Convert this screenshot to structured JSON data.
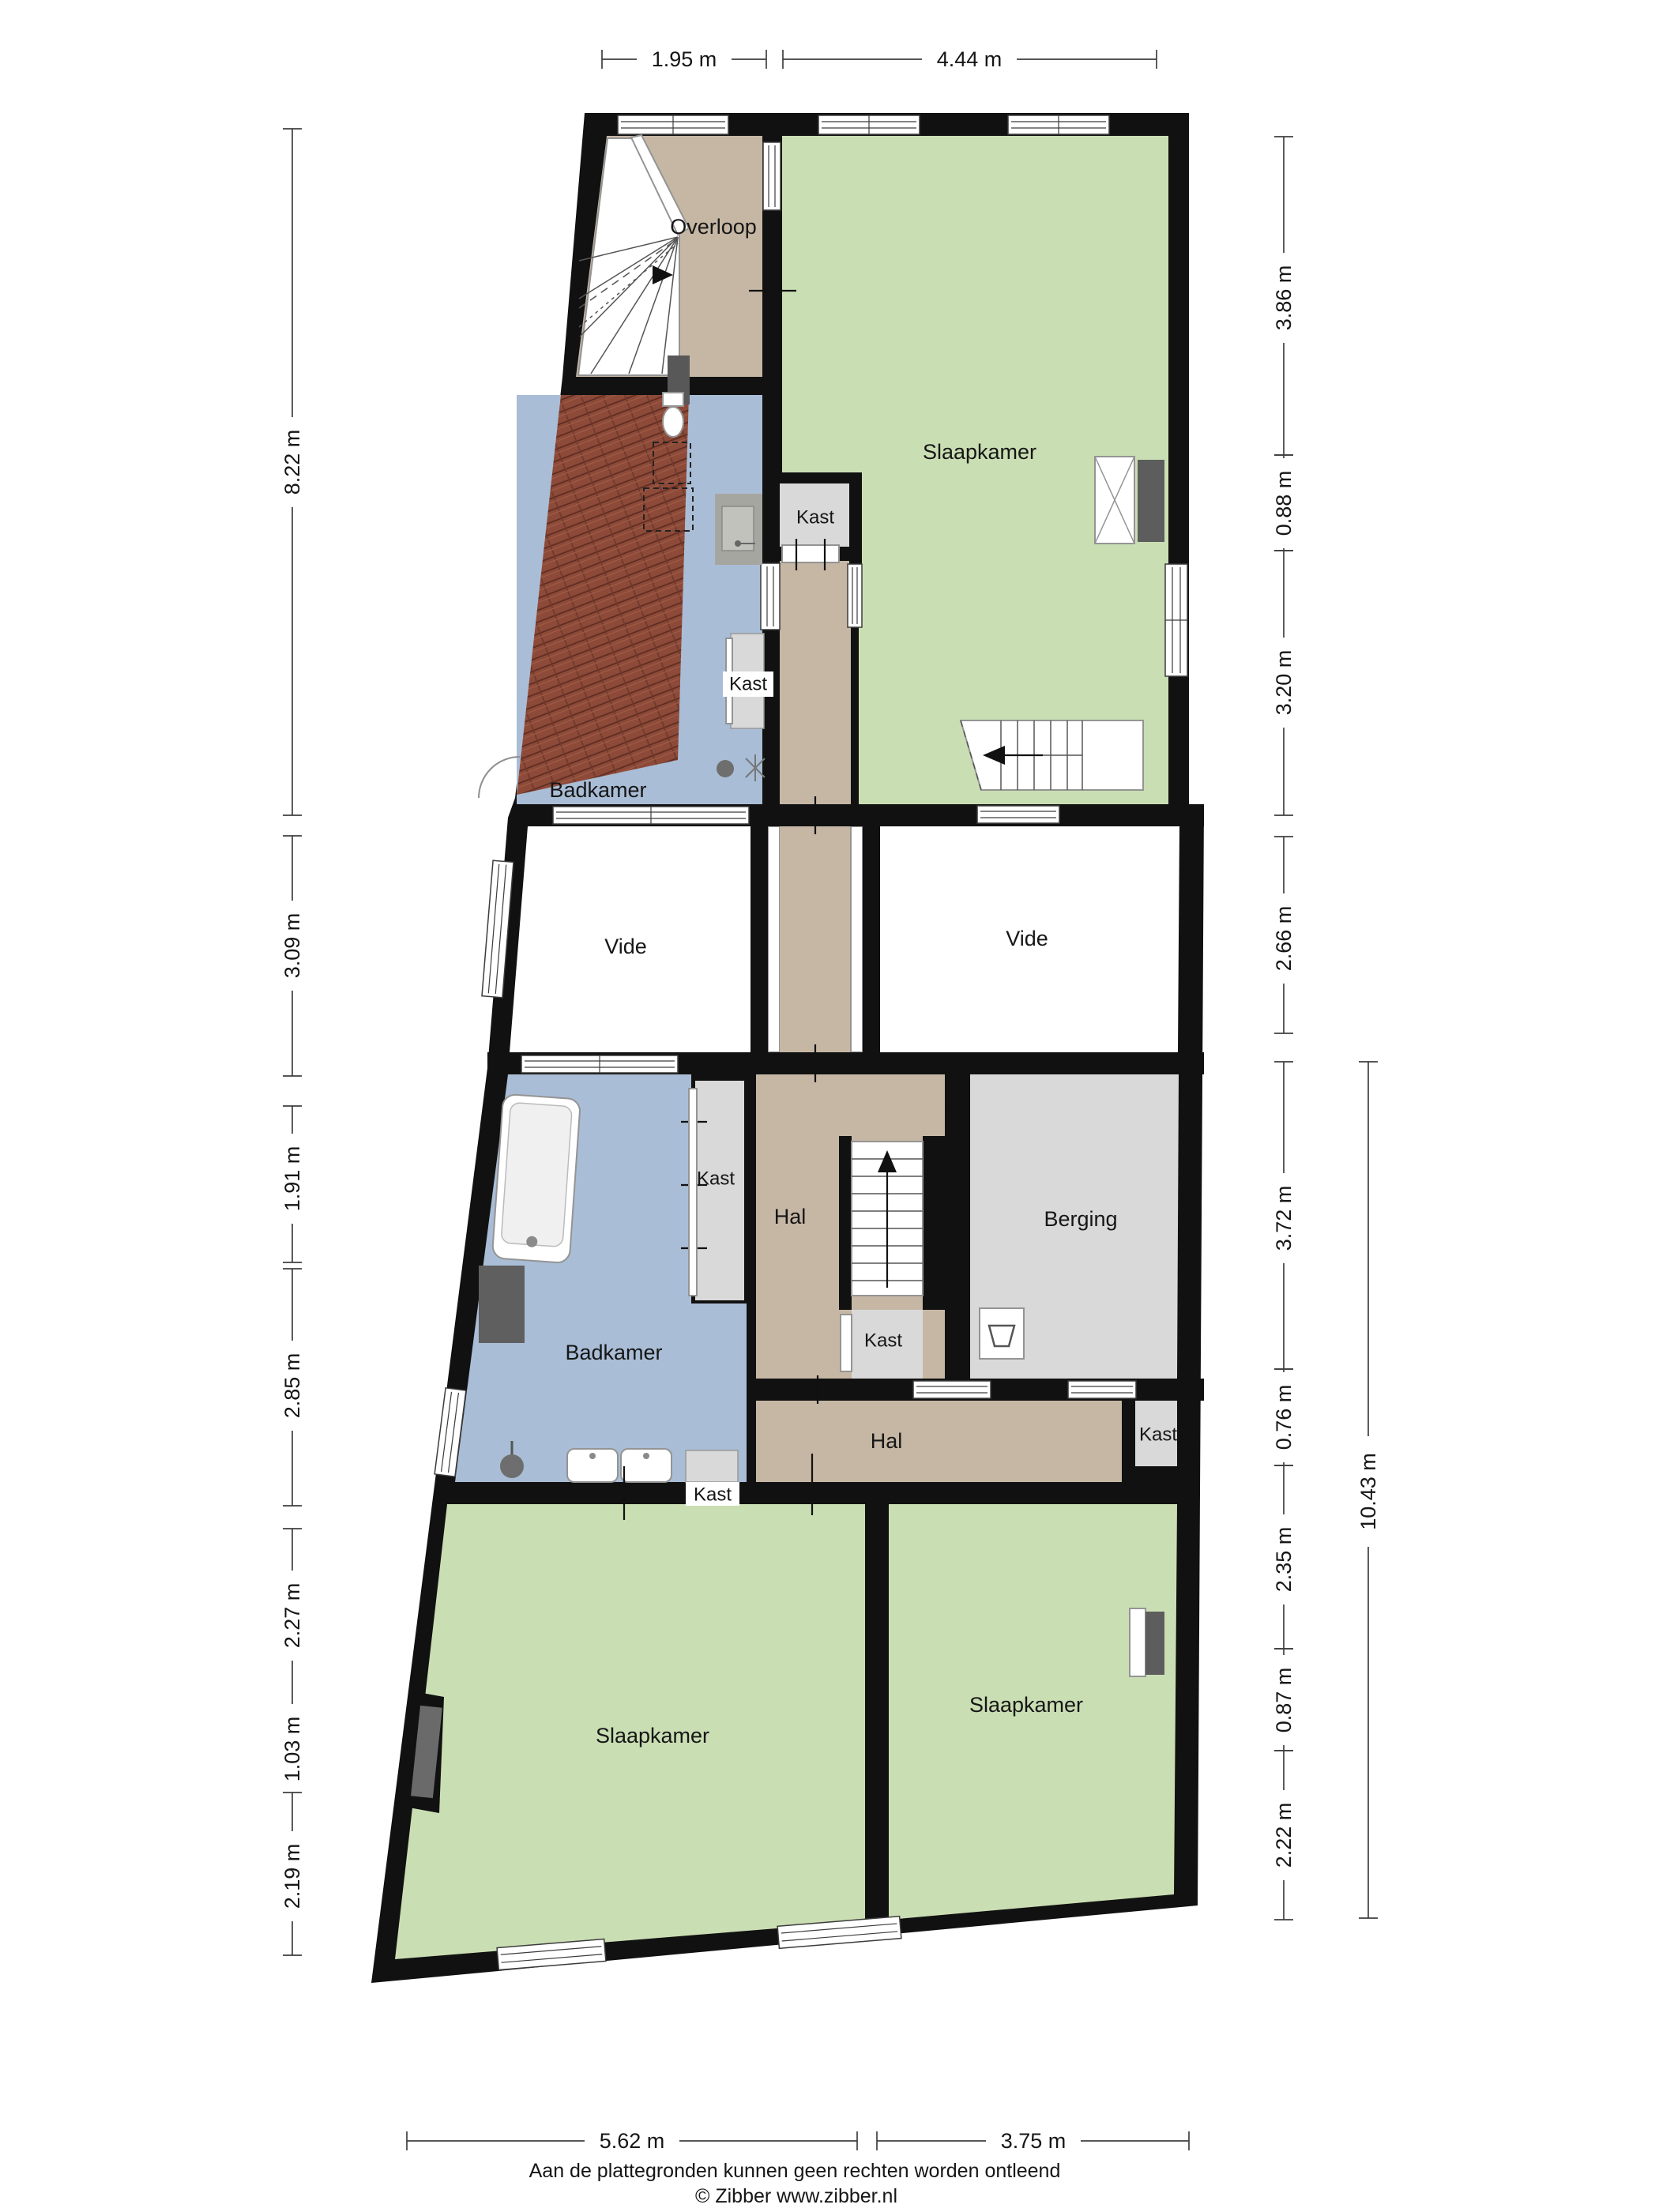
{
  "rooms": [
    {
      "id": "overloop",
      "label": "Overloop"
    },
    {
      "id": "slaapkamer-top",
      "label": "Slaapkamer"
    },
    {
      "id": "kast-top",
      "label": "Kast"
    },
    {
      "id": "kast-badkamer-top",
      "label": "Kast"
    },
    {
      "id": "badkamer-top",
      "label": "Badkamer"
    },
    {
      "id": "vide-left",
      "label": "Vide"
    },
    {
      "id": "vide-right",
      "label": "Vide"
    },
    {
      "id": "kast-mid",
      "label": "Kast"
    },
    {
      "id": "hal-mid",
      "label": "Hal"
    },
    {
      "id": "berging",
      "label": "Berging"
    },
    {
      "id": "kast-under-stairs",
      "label": "Kast"
    },
    {
      "id": "badkamer-low",
      "label": "Badkamer"
    },
    {
      "id": "kast-hal-low",
      "label": "Kast"
    },
    {
      "id": "hal-low",
      "label": "Hal"
    },
    {
      "id": "kast-badkamer-low",
      "label": "Kast"
    },
    {
      "id": "slaapkamer-left",
      "label": "Slaapkamer"
    },
    {
      "id": "slaapkamer-right",
      "label": "Slaapkamer"
    }
  ],
  "dimensions": {
    "top": [
      "1.95 m",
      "4.44 m"
    ],
    "left": [
      "8.22 m",
      "3.09 m",
      "1.91 m",
      "2.85 m",
      "2.27 m",
      "1.03 m",
      "2.19 m"
    ],
    "right": [
      "3.86 m",
      "0.88 m",
      "3.20 m",
      "2.66 m",
      "3.72 m",
      "0.76 m",
      "2.35 m",
      "0.87 m",
      "2.22 m"
    ],
    "right_total": "10.43 m",
    "bottom": [
      "5.62 m",
      "3.75 m"
    ]
  },
  "footer": {
    "disclaimer": "Aan de plattegronden kunnen geen rechten worden ontleend",
    "credit": "© Zibber www.zibber.nl"
  },
  "colors": {
    "bedroom_green": "#cadeb3",
    "hall_tan": "#c6b7a4",
    "bath_blue": "#a9bdd6",
    "closet_gray": "#d9d9d9",
    "void_white": "#ffffff",
    "roof_tile": "#8d4a38",
    "wall_black": "#111111"
  }
}
